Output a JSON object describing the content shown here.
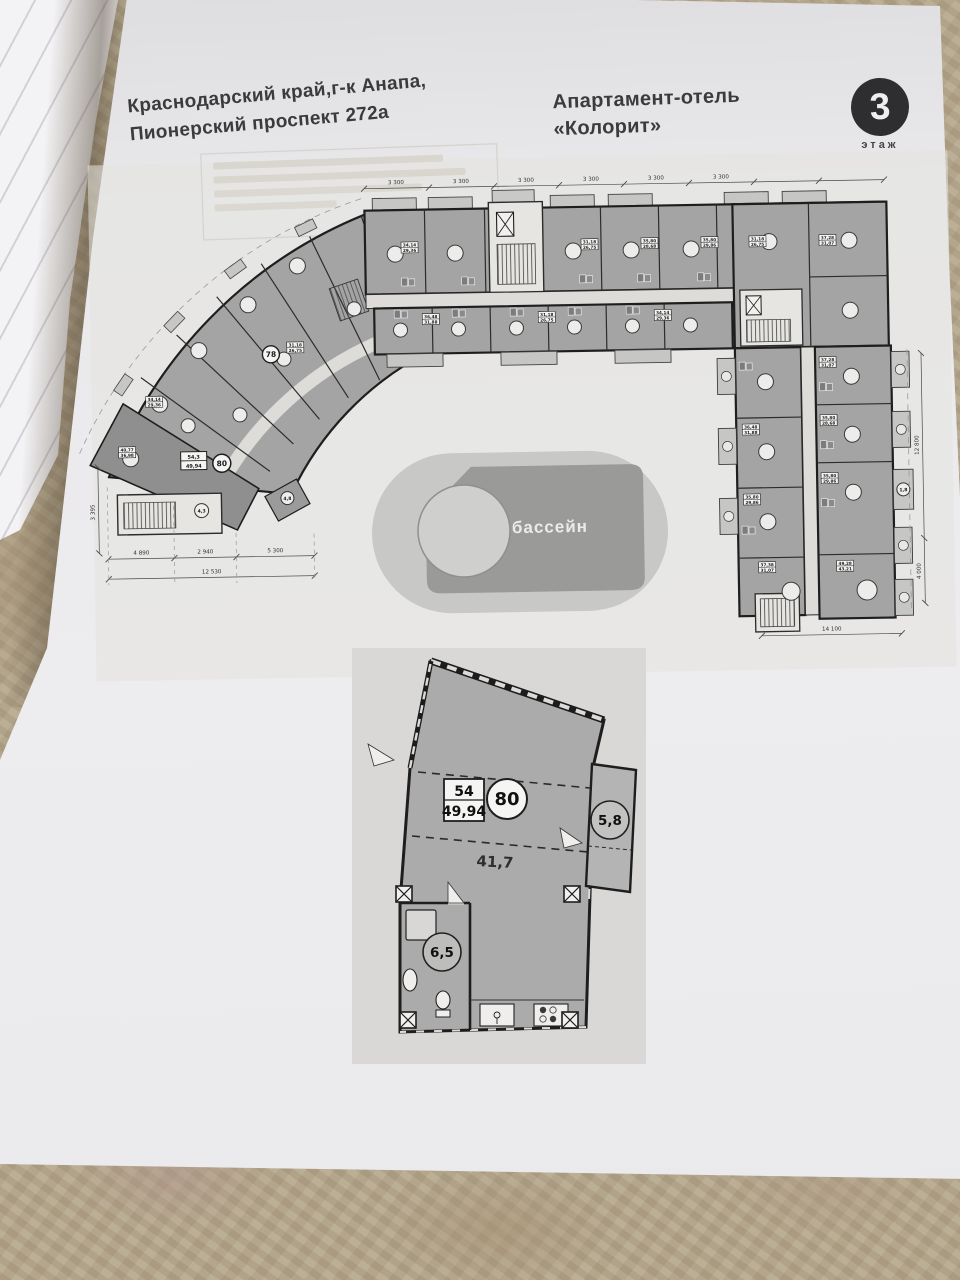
{
  "header": {
    "address_line1": "Краснодарский край,г-к Анапа,",
    "address_line2": "Пионерский проспект 272а",
    "hotel_name_line1": "Апартамент-отель",
    "hotel_name_line2": "«Колорит»",
    "floor_number": "3",
    "floor_label": "этаж"
  },
  "floor_plan": {
    "pool_label": "бассейн",
    "unit_78": "78",
    "unit_80": "80",
    "circle_labels": {
      "entry": "4,3",
      "small_room": "4,8",
      "balcony": "1,8"
    },
    "micro_areas": [
      {
        "a": "37,28",
        "b": "31,07"
      },
      {
        "a": "35,80",
        "b": "28,68"
      },
      {
        "a": "36,48",
        "b": "31,88"
      },
      {
        "a": "35,80",
        "b": "29,86"
      },
      {
        "a": "37,38",
        "b": "31,07"
      },
      {
        "a": "49,28",
        "b": "43,21"
      },
      {
        "a": "40,77",
        "b": "36,98"
      },
      {
        "a": "54,3",
        "b": "49,94"
      },
      {
        "a": "34,14",
        "b": "29,36"
      },
      {
        "a": "31,18",
        "b": "26,75"
      }
    ],
    "dimensions": {
      "top": [
        "3 300",
        "3 300",
        "3 300",
        "3 300",
        "3 300",
        "3 300"
      ],
      "bottom_left_segments": [
        "4 890",
        "2 940",
        "5 300"
      ],
      "bottom_left_total": "12 530",
      "bottom_right": "14 100",
      "left_vertical": "3 395",
      "right_vertical_1": "12 800",
      "right_vertical_2": "4 000"
    }
  },
  "unit_detail": {
    "area_box_top": "54",
    "area_box_bottom": "49,94",
    "unit_number": "80",
    "living_area": "41,7",
    "balcony_area": "5,8",
    "bathroom_area": "6,5"
  },
  "colors": {
    "paper": "#ebeaec",
    "tablecloth": "#b5aa90",
    "ink": "#3b3b3e",
    "plan_unit_gray": "#a4a4a4",
    "plan_unit_dark": "#8f8f8f",
    "pool_outer": "#c8c8c6",
    "pool_inner": "#9a9a98",
    "badge_background": "#2e2e31"
  }
}
